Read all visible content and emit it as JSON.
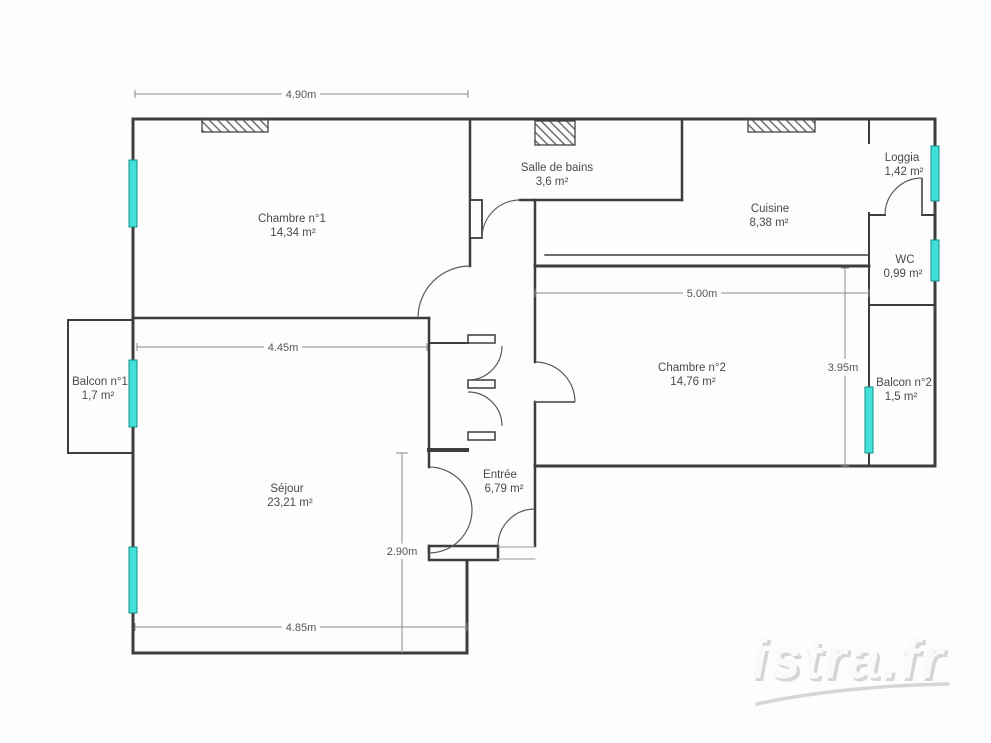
{
  "colors": {
    "wall": "#3d3d3d",
    "door": "#5a5a5a",
    "window_fill": "#41e0d9",
    "window_border": "#148f8b",
    "dimension_line": "#8a8a8a",
    "label_text": "#4a4a4a",
    "watermark": "#cfcfcf"
  },
  "rooms": [
    {
      "name": "Chambre n°1",
      "area": "14,34 m²"
    },
    {
      "name": "Salle de bains",
      "area": "3,6 m²"
    },
    {
      "name": "Cuisine",
      "area": "8,38 m²"
    },
    {
      "name": "Loggia",
      "area": "1,42 m²"
    },
    {
      "name": "WC",
      "area": "0,99 m²"
    },
    {
      "name": "Chambre n°2",
      "area": "14,76 m²"
    },
    {
      "name": "Balcon n°2",
      "area": "1,5 m²"
    },
    {
      "name": "Balcon n°1",
      "area": "1,7 m²"
    },
    {
      "name": "Séjour",
      "area": "23,21 m²"
    },
    {
      "name": "Entrée",
      "area": "6,79 m²"
    }
  ],
  "dimensions": [
    {
      "label": "4.90m"
    },
    {
      "label": "4.45m"
    },
    {
      "label": "5.00m"
    },
    {
      "label": "4.85m"
    },
    {
      "label": "3.95m"
    },
    {
      "label": "2.90m"
    }
  ],
  "watermark": {
    "text": "istra.fr"
  }
}
